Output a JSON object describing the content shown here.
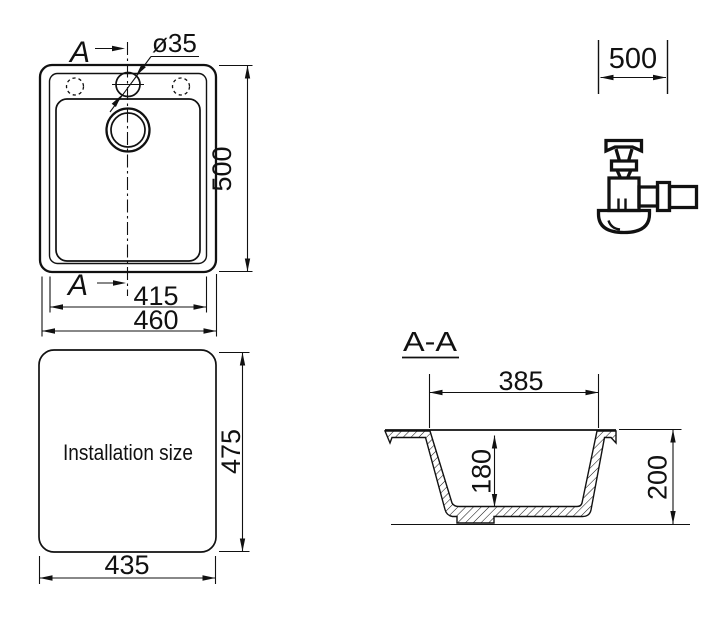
{
  "colors": {
    "line": "#111111",
    "background": "#ffffff"
  },
  "plan_view": {
    "section_arrow_top_label": "A",
    "section_arrow_bottom_label": "A",
    "tap_hole_diameter": "ø35",
    "dim_bowl_width": "415",
    "dim_overall_width": "460",
    "dim_overall_depth": "500"
  },
  "cabinet_dimension": {
    "value": "500"
  },
  "icons": {
    "siphon": "siphon-drain-trap-icon"
  },
  "installation_view": {
    "label": "Installation size",
    "dim_width": "435",
    "dim_depth": "475"
  },
  "section_view": {
    "title": "A-A",
    "dim_bowl_top_width": "385",
    "dim_bowl_depth": "180",
    "dim_overall_height": "200"
  }
}
